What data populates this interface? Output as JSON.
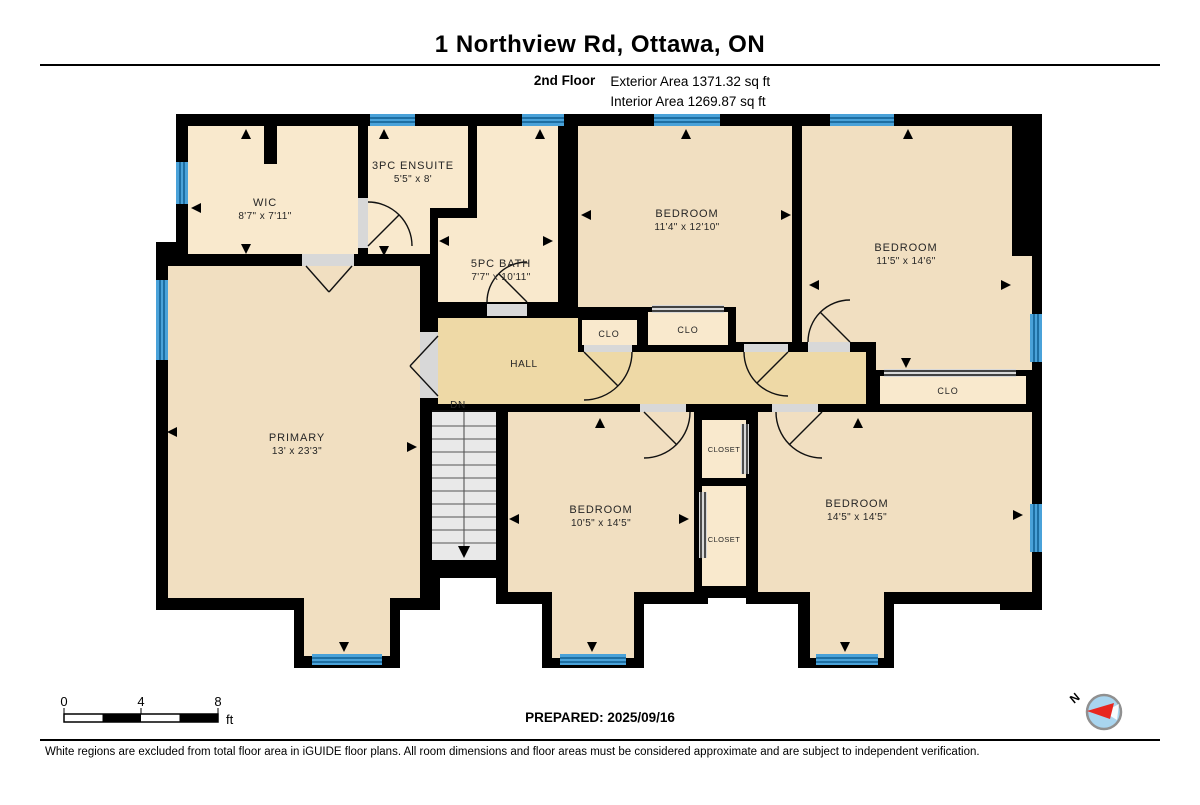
{
  "header": {
    "title": "1 Northview Rd, Ottawa, ON",
    "floor_label": "2nd Floor",
    "exterior_area": "Exterior Area 1371.32 sq ft",
    "interior_area": "Interior Area 1269.87 sq ft"
  },
  "rooms": {
    "wic": {
      "name": "WIC",
      "dims": "8'7\" x 7'11\""
    },
    "ensuite": {
      "name": "3PC ENSUITE",
      "dims": "5'5\" x 8'"
    },
    "bath": {
      "name": "5PC BATH",
      "dims": "7'7\" x 10'11\""
    },
    "bedroom_ne": {
      "name": "BEDROOM",
      "dims": "11'4\" x 12'10\""
    },
    "bedroom_e": {
      "name": "BEDROOM",
      "dims": "11'5\" x 14'6\""
    },
    "hall": {
      "name": "HALL"
    },
    "primary": {
      "name": "PRIMARY",
      "dims": "13' x 23'3\""
    },
    "bedroom_s": {
      "name": "BEDROOM",
      "dims": "10'5\" x 14'5\""
    },
    "bedroom_se": {
      "name": "BEDROOM",
      "dims": "14'5\" x 14'5\""
    },
    "clo_a": {
      "name": "CLO"
    },
    "clo_b": {
      "name": "CLO"
    },
    "clo_e": {
      "name": "CLO"
    },
    "closet_top": {
      "name": "CLOSET"
    },
    "closet_bottom": {
      "name": "CLOSET"
    }
  },
  "stairs": {
    "label": "DN"
  },
  "scale_bar": {
    "tick0": "0",
    "tick1": "4",
    "tick2": "8",
    "unit": "ft"
  },
  "compass": {
    "label": "N"
  },
  "footer": {
    "prepared": "PREPARED: 2025/09/16",
    "disclaimer": "White regions are excluded from total floor area in iGUIDE floor plans. All room dimensions and floor areas must be considered approximate and are subject to independent verification."
  },
  "colors": {
    "wall": "#000000",
    "room": "#f1dfc1",
    "closet": "#f9e9cd",
    "hall": "#eed9a6",
    "window": "#4aa2d9",
    "window_stripe": "#1e6fa3",
    "stairs": "#e9e9e9",
    "threshold": "#d8d8d8",
    "door_line": "#111111",
    "compass_face": "#a9d5ef",
    "compass_needle": "#e8261f"
  }
}
